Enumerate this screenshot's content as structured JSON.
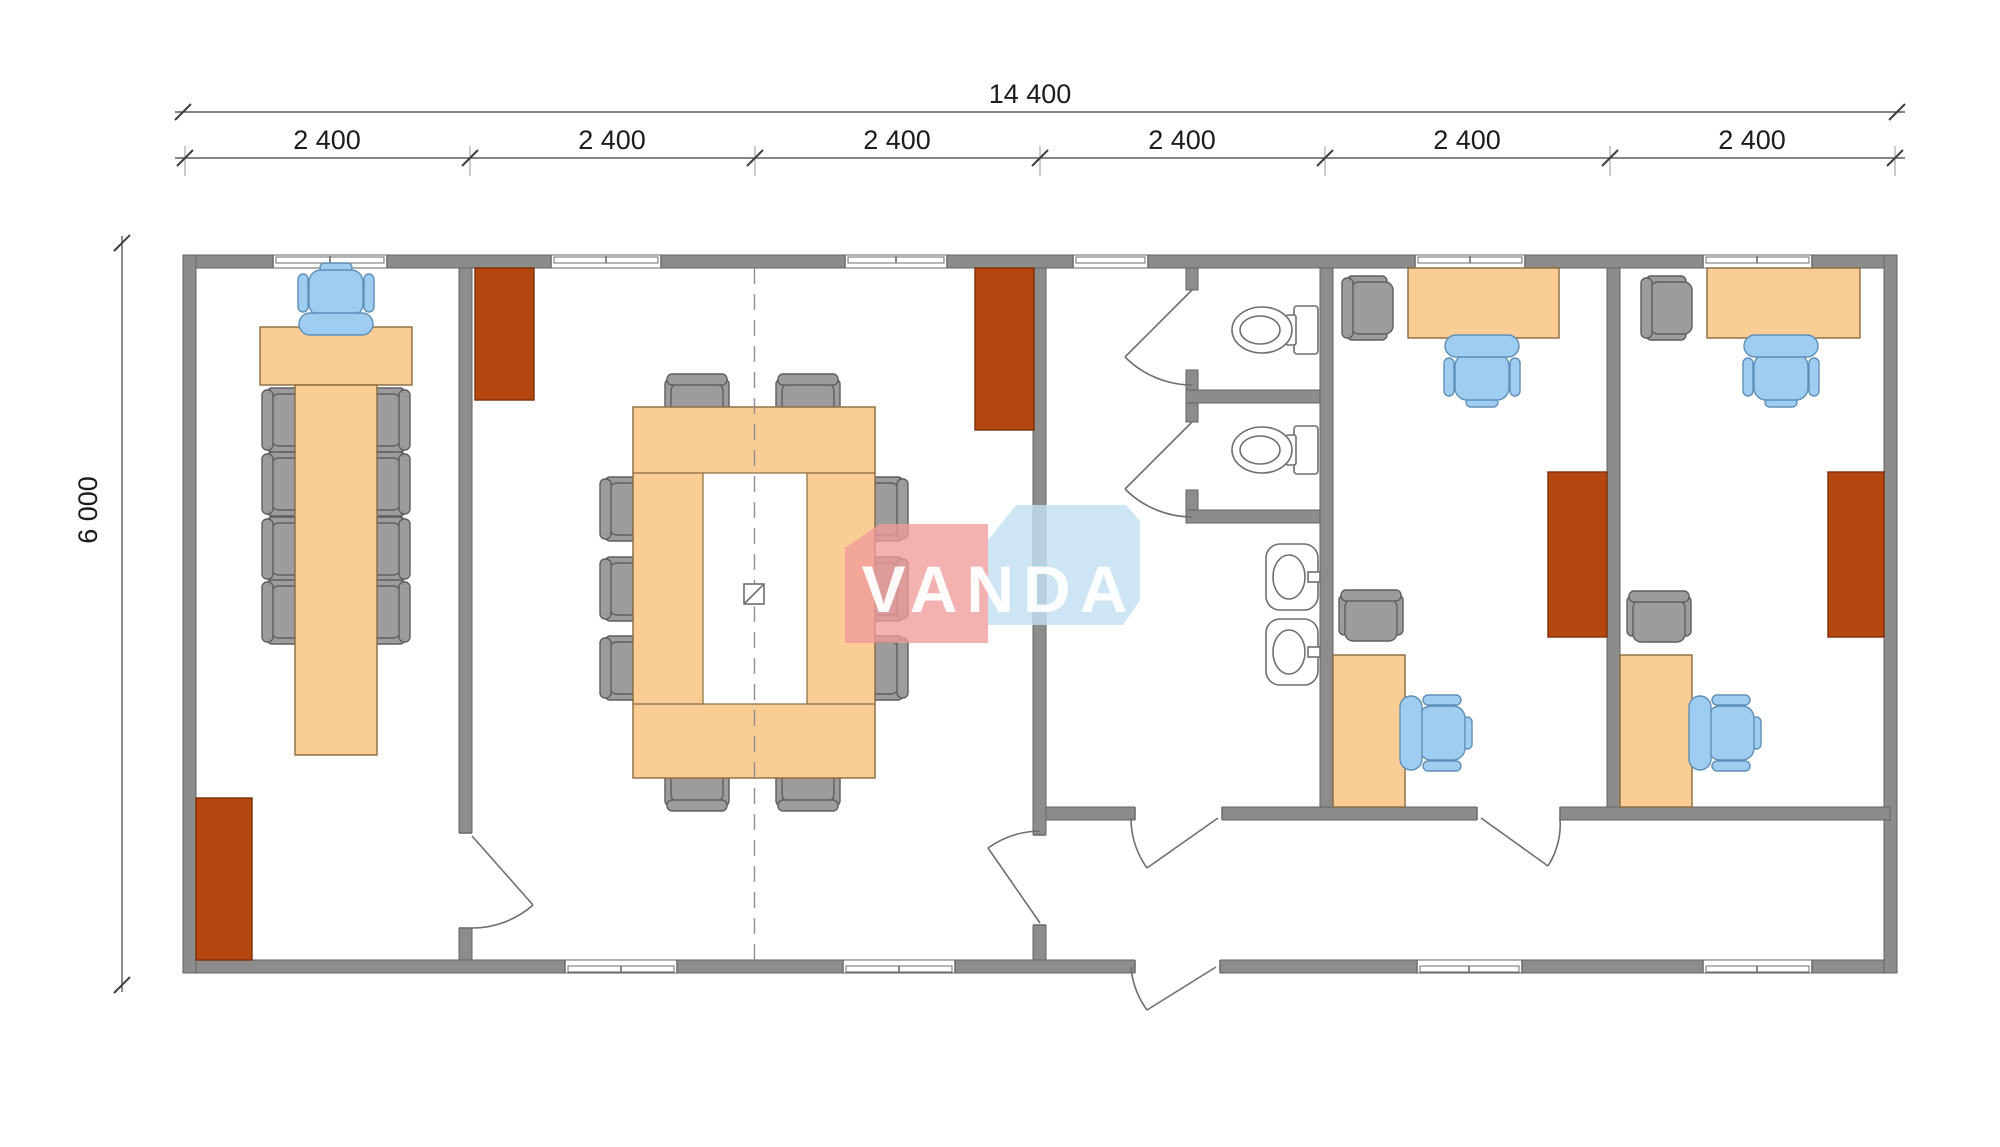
{
  "dimensions": {
    "total_width_label": "14 400",
    "total_width_value": 14400,
    "module_labels": [
      "2 400",
      "2 400",
      "2 400",
      "2 400",
      "2 400",
      "2 400"
    ],
    "module_value": 2400,
    "height_label": "6 000",
    "height_value": 6000
  },
  "watermark": {
    "text": "VANDA"
  },
  "palette": {
    "wall": "#8c8c8c",
    "wall_edge": "#636363",
    "wood": "#facd96",
    "wood_edge": "#8a6a3e",
    "radiator": "#b4470f",
    "radiator_edge": "#7c2f08",
    "chair_gray": "#9c9c9c",
    "chair_gray_edge": "#5e5e5e",
    "chair_blue": "#9ecdf1",
    "chair_blue_edge": "#5f8fb7",
    "fixture_edge": "#6e6e6e",
    "centerline": "#8f8f8f",
    "dim_line": "#3f3f3f",
    "dim_ext": "#9a9a9a",
    "dim_text": "#1c1c1c",
    "watermark_red": "#f09b9b",
    "watermark_blue": "#c3dff2",
    "watermark_text": "#ffffff"
  },
  "plan": {
    "rooms": [
      {
        "id": "office-left",
        "furniture": [
          "executive-chair-blue",
          "desk",
          "long-table",
          "side-chairs-x8",
          "radiator"
        ]
      },
      {
        "id": "meeting-room",
        "furniture": [
          "hollow-conference-table",
          "side-chairs-x10",
          "radiator-x2",
          "floor-box-symbol",
          "centerline"
        ]
      },
      {
        "id": "sanitary-block",
        "furniture": [
          "toilet-x2",
          "stall-door-x2",
          "washbasin-x2"
        ]
      },
      {
        "id": "office-right-1",
        "furniture": [
          "desk",
          "task-chair-blue",
          "side-chair",
          "corner-desk",
          "task-chair-blue",
          "side-chair",
          "radiator"
        ]
      },
      {
        "id": "office-right-2",
        "furniture": [
          "desk",
          "task-chair-blue",
          "side-chair",
          "corner-desk",
          "task-chair-blue",
          "side-chair",
          "radiator"
        ]
      }
    ],
    "doors": 7,
    "windows_top": 6,
    "windows_bottom": 4,
    "entrance_doors": 1
  }
}
